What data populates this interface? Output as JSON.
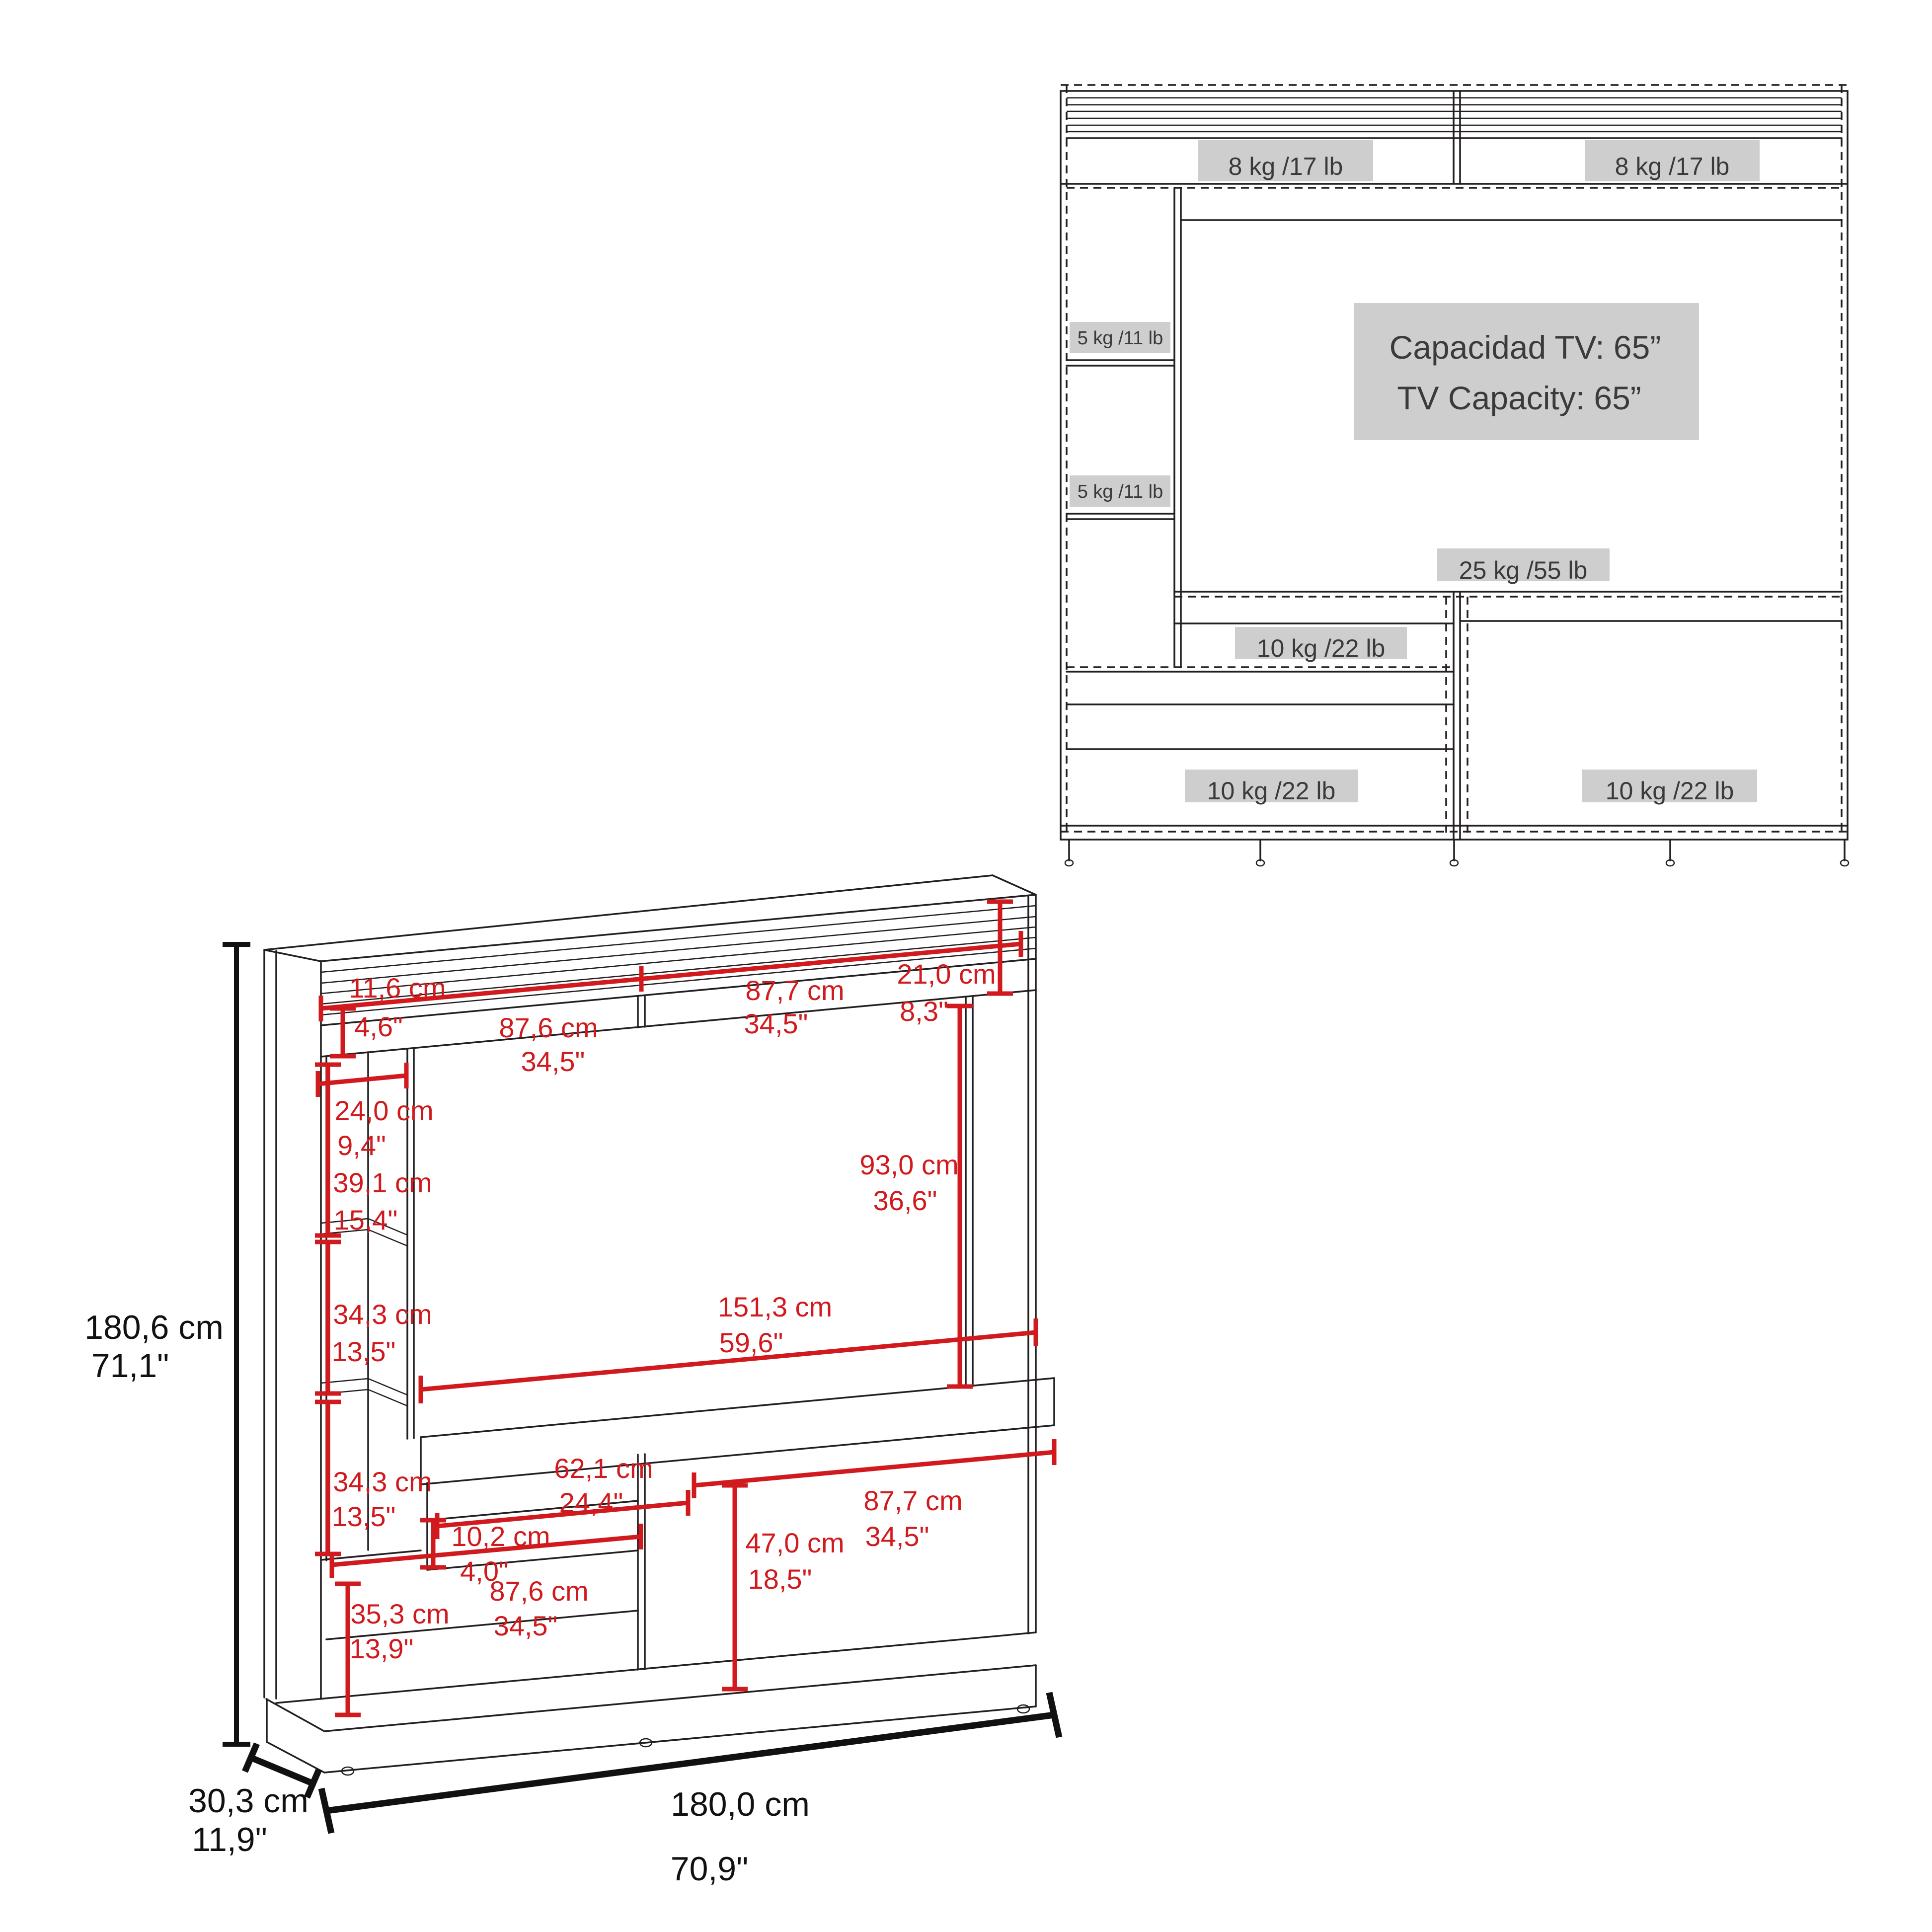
{
  "colors": {
    "accent_red": "#d11a1e",
    "line_black": "#231f20",
    "label_bg": "#cecece",
    "label_text": "#3a3a3a"
  },
  "front_view": {
    "tv_capacity": {
      "line1": "Capacidad TV: 65”",
      "line2": "TV Capacity: 65”"
    },
    "weight_labels": {
      "hutch_left": "8 kg /17 lb",
      "hutch_right": "8 kg /17 lb",
      "side_shelf_upper": "5 kg /11 lb",
      "side_shelf_lower": "5 kg /11 lb",
      "tv_shelf": "25 kg /55 lb",
      "middle_shelf": "10 kg /22 lb",
      "cabinet_left": "10 kg /22 lb",
      "cabinet_right": "10 kg /22 lb"
    }
  },
  "dimension_view": {
    "overall": {
      "height": {
        "cm": "180,6 cm",
        "in": "71,1\""
      },
      "width": {
        "cm": "180,0 cm",
        "in": "70,9\""
      },
      "depth": {
        "cm": "30,3 cm",
        "in": "11,9\""
      }
    },
    "details": {
      "top_shelf_height": {
        "cm": "11,6 cm",
        "in": "4,6\""
      },
      "top_left_span": {
        "cm": "87,6 cm",
        "in": "34,5\""
      },
      "top_right_span": {
        "cm": "87,7 cm",
        "in": "34,5\""
      },
      "hutch_height": {
        "cm": "21,0 cm",
        "in": "8,3\""
      },
      "tower_width": {
        "cm": "24,0 cm",
        "in": "9,4\""
      },
      "tower_top_section": {
        "cm": "39,1 cm",
        "in": "15,4\""
      },
      "tower_mid_section": {
        "cm": "34,3 cm",
        "in": "13,5\""
      },
      "tower_bottom_section": {
        "cm": "34,3 cm",
        "in": "13,5\""
      },
      "tv_opening_width": {
        "cm": "151,3 cm",
        "in": "59,6\""
      },
      "tv_opening_height": {
        "cm": "93,0 cm",
        "in": "36,6\""
      },
      "media_shelf_width": {
        "cm": "62,1 cm",
        "in": "24,4\""
      },
      "media_shelf_height": {
        "cm": "10,2 cm",
        "in": "4,0\""
      },
      "cabinet_left_width": {
        "cm": "87,6 cm",
        "in": "34,5\""
      },
      "cabinet_left_height": {
        "cm": "35,3 cm",
        "in": "13,9\""
      },
      "cabinet_right_width": {
        "cm": "87,7 cm",
        "in": "34,5\""
      },
      "cabinet_right_height": {
        "cm": "47,0 cm",
        "in": "18,5\""
      }
    }
  }
}
